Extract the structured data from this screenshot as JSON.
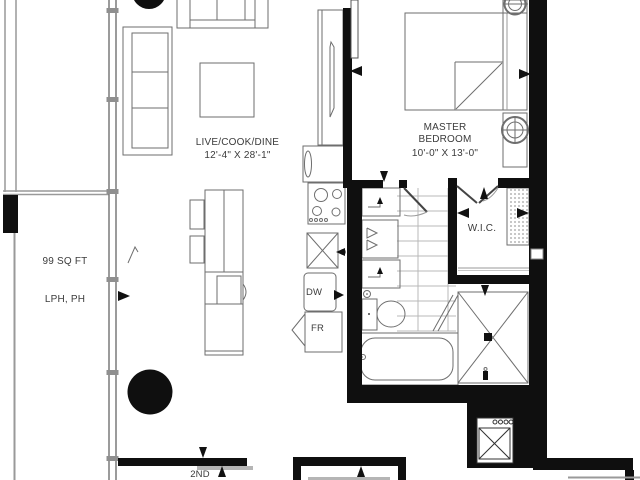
{
  "floorplan": {
    "rooms": {
      "living": {
        "name": "LIVE/COOK/DINE",
        "dimensions": "12'-4\" X 28'-1\""
      },
      "master_bedroom": {
        "name_line1": "MASTER",
        "name_line2": "BEDROOM",
        "dimensions": "10'-0\" X 13'-0\""
      },
      "wic": {
        "name": "W.I.C."
      },
      "balcony": {
        "area": "99 SQ FT",
        "levels": "LPH, PH"
      }
    },
    "appliances": {
      "dishwasher": "DW",
      "fridge": "FR"
    },
    "labels": {
      "second_floor": "2ND"
    },
    "colors": {
      "wall": "#0f0f0f",
      "furniture": "#6e6e6e",
      "grid": "#b8b8b8",
      "rail": "#999999",
      "text": "#3b3b3b"
    }
  }
}
